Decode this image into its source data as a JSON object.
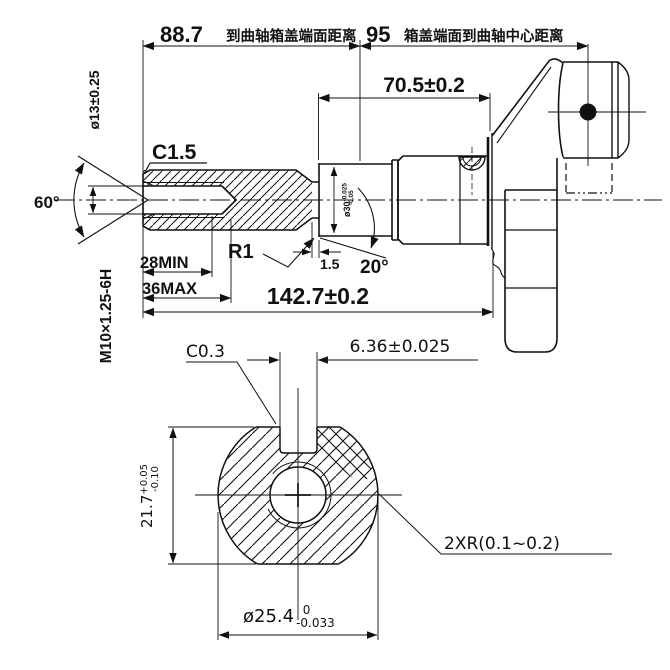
{
  "colors": {
    "line": "#111111",
    "background": "#ffffff"
  },
  "top_dimensions": {
    "to_case_face": {
      "value": "88.7",
      "note": "到曲轴箱盖端面距离"
    },
    "face_to_center": {
      "value": "95",
      "note": "箱盖端面到曲轴中心距离"
    },
    "journal_to_web": "70.5±0.2"
  },
  "main_view": {
    "end_chamfer": "C1.5",
    "countersink_dia": "ø13±0.25",
    "countersink_angle": "60°",
    "thread_spec": "M10×1.25-6H",
    "thread_depth_min": "28MIN",
    "thread_depth_max": "36MAX",
    "undercut_fillet": "R1",
    "undercut_width": "1.5",
    "chamfer_angle": "20°",
    "journal_dia": {
      "value": "ø30",
      "upper": "-0.025",
      "lower": "-0.05"
    },
    "overall_length": "142.7±0.2"
  },
  "section_view": {
    "keyway_chamfer": "C0.3",
    "keyway_width": "6.36±0.025",
    "across_flats": {
      "value": "21.7",
      "upper": "+0.05",
      "lower": "-0.10"
    },
    "shaft_dia": {
      "value": "ø25.4",
      "upper": "0",
      "lower": "-0.033"
    },
    "flat_fillets": "2XR(0.1~0.2)"
  }
}
